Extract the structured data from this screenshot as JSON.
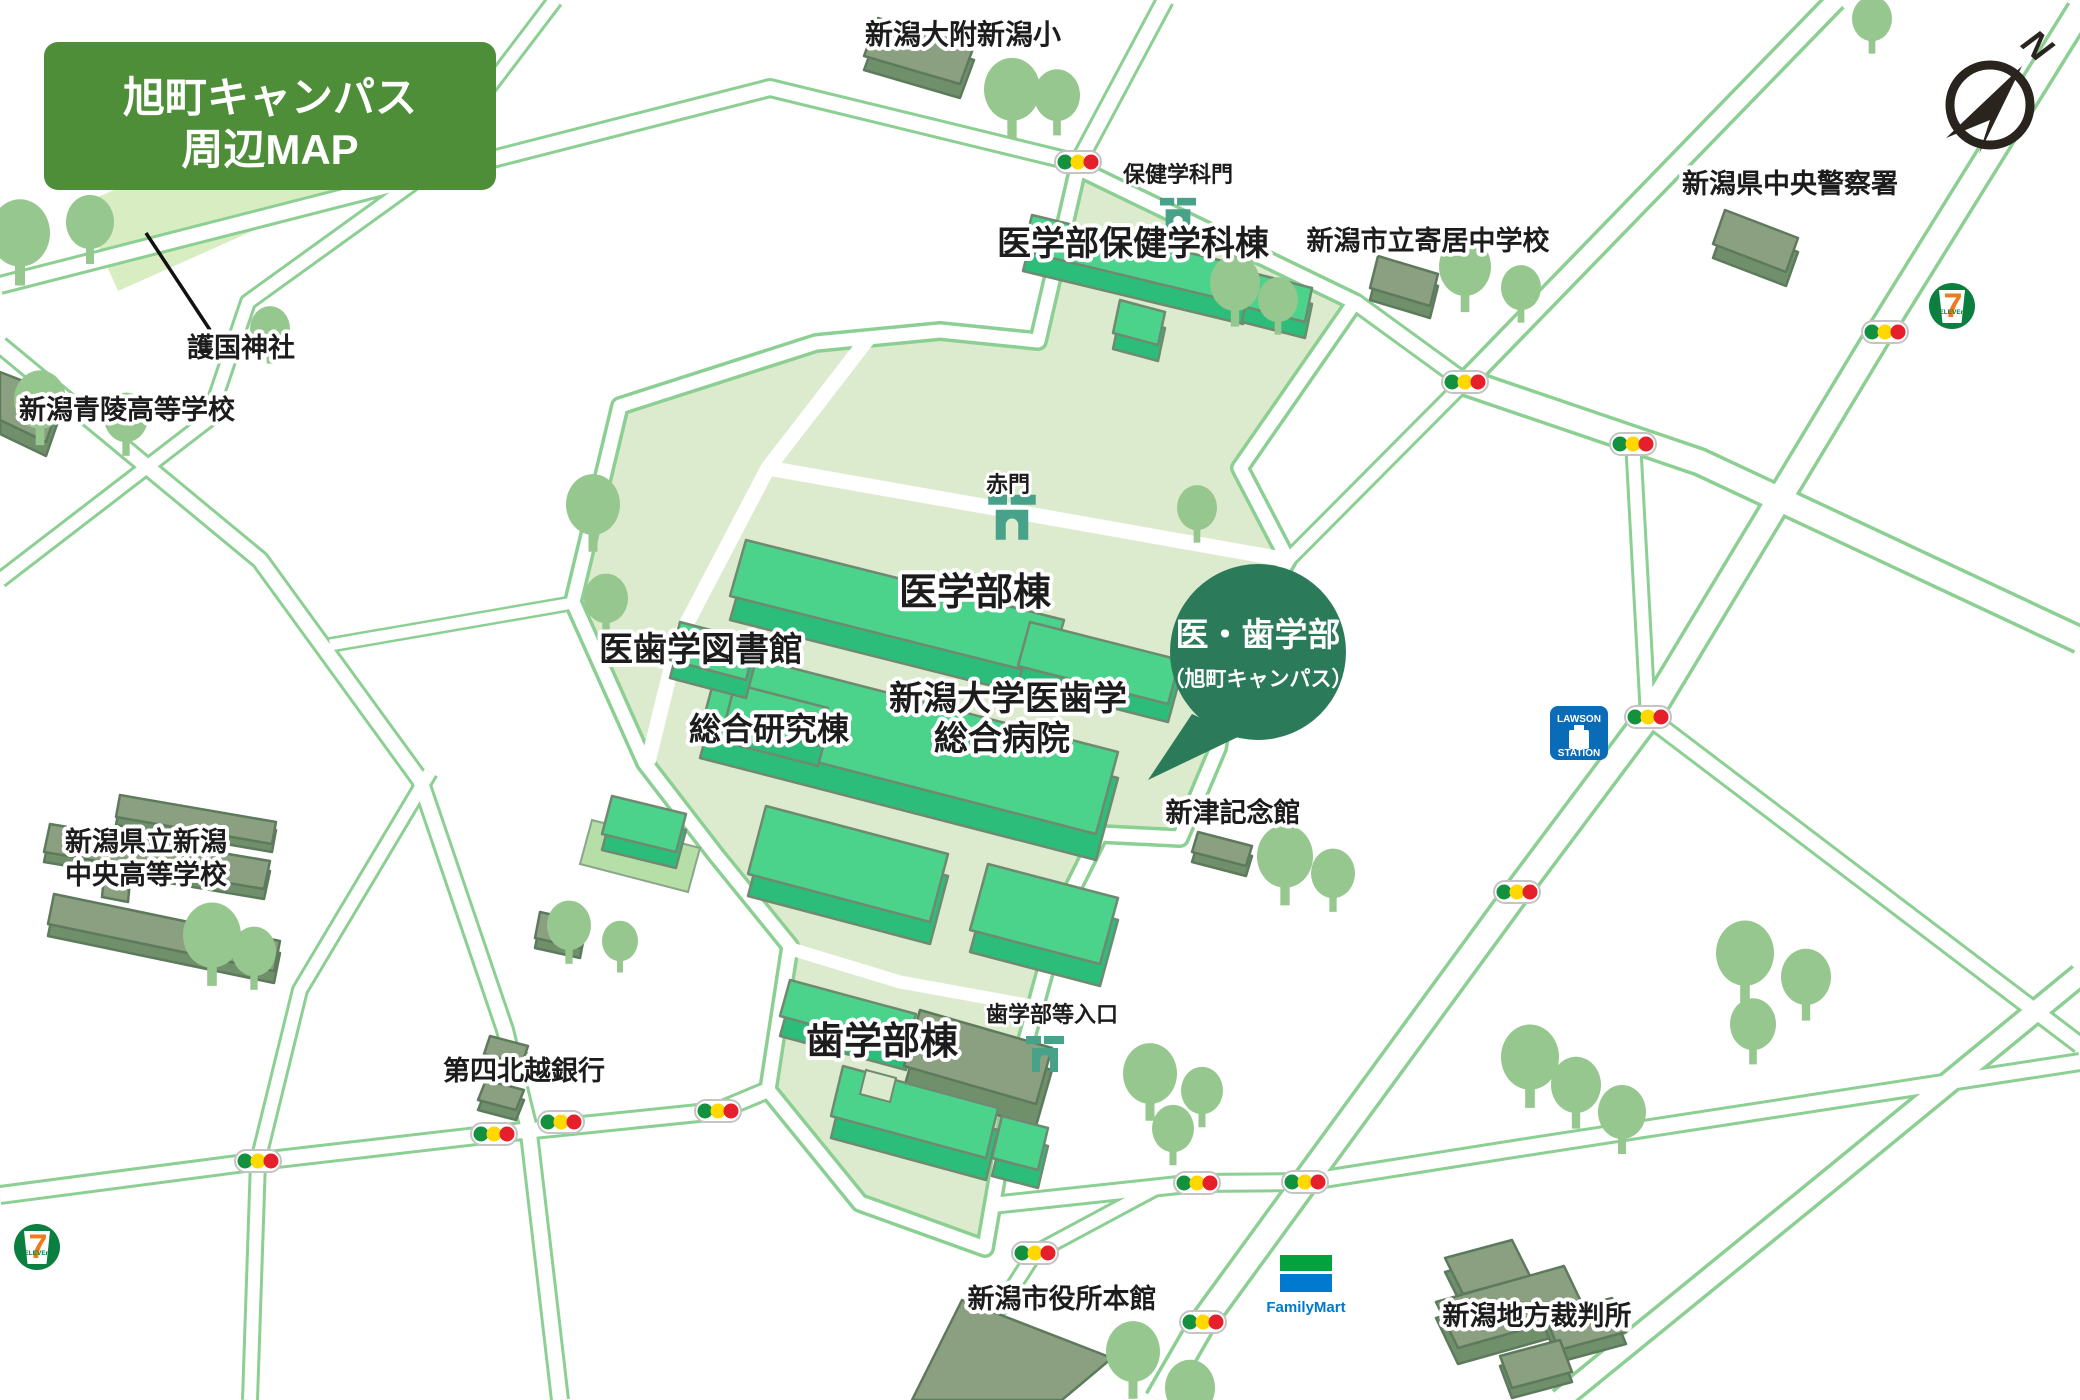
{
  "title": {
    "line1": "旭町キャンパス",
    "line2": "周辺MAP"
  },
  "callout": {
    "line1": "医・歯学部",
    "line2": "（旭町キャンパス）"
  },
  "labels": {
    "elementary": "新潟大附新潟小",
    "health_gate": "保健学科門",
    "health_dept": "医学部保健学科棟",
    "yorii_jhs": "新潟市立寄居中学校",
    "police": "新潟県中央警察署",
    "shrine": "護国神社",
    "seiryo_hs": "新潟青陵高等学校",
    "akamon": "赤門",
    "med_bldg": "医学部棟",
    "library": "医歯学図書館",
    "research": "総合研究棟",
    "hospital_l1": "新潟大学医歯学",
    "hospital_l2": "総合病院",
    "niitsu": "新津記念館",
    "dent_gate": "歯学部等入口",
    "dent_bldg": "歯学部棟",
    "chuo_hs_l1": "新潟県立新潟",
    "chuo_hs_l2": "中央高等学校",
    "bank": "第四北越銀行",
    "city_hall": "新潟市役所本館",
    "court": "新潟地方裁判所"
  },
  "stores": {
    "seven_7": "7",
    "seven_eleven": "ELEVEn",
    "lawson_top": "LAWSON",
    "lawson_bottom": "STATION",
    "familymart": "FamilyMart"
  },
  "compass": {
    "letter": "N"
  },
  "colors": {
    "title_bg": "#4e8e39",
    "campus": "#dcebcd",
    "shrine": "#d9edc3",
    "road_casing": "#8ccf93",
    "building_top": "#4bd38b",
    "building_side": "#2dbd7a",
    "offcampus_building": "#8ba081",
    "tree": "#96c78e",
    "gate": "#47a289",
    "callout_bg": "#2b7a5a",
    "signal_green": "#14913f",
    "signal_yellow": "#ffd800",
    "signal_red": "#e51f2b",
    "seven_green": "#0b7f3f",
    "seven_orange": "#ef7b1a",
    "lawson_blue": "#0a6bb7",
    "familymart_green": "#00a33e",
    "familymart_blue": "#0079cf"
  },
  "map": {
    "trees": [
      [
        20,
        238,
        30
      ],
      [
        90,
        226,
        24
      ],
      [
        40,
        404,
        26
      ],
      [
        126,
        421,
        22
      ],
      [
        270,
        332,
        20
      ],
      [
        1012,
        94,
        28
      ],
      [
        1057,
        99,
        23
      ],
      [
        1235,
        287,
        25
      ],
      [
        1278,
        303,
        20
      ],
      [
        1465,
        271,
        26
      ],
      [
        1521,
        291,
        20
      ],
      [
        1872,
        22,
        20
      ],
      [
        1197,
        511,
        20
      ],
      [
        593,
        509,
        27
      ],
      [
        606,
        602,
        22
      ],
      [
        569,
        929,
        22
      ],
      [
        620,
        944,
        18
      ],
      [
        212,
        940,
        29
      ],
      [
        254,
        955,
        22
      ],
      [
        1285,
        861,
        28
      ],
      [
        1333,
        877,
        22
      ],
      [
        1530,
        1062,
        29
      ],
      [
        1576,
        1089,
        25
      ],
      [
        1622,
        1116,
        24
      ],
      [
        1745,
        958,
        29
      ],
      [
        1806,
        981,
        25
      ],
      [
        1753,
        1028,
        23
      ],
      [
        1150,
        1078,
        27
      ],
      [
        1202,
        1094,
        21
      ],
      [
        1173,
        1132,
        21
      ],
      [
        1133,
        1356,
        27
      ],
      [
        1190,
        1392,
        25
      ]
    ],
    "signals": [
      [
        1078,
        162
      ],
      [
        1885,
        332
      ],
      [
        1465,
        382
      ],
      [
        1633,
        444
      ],
      [
        1648,
        717
      ],
      [
        1517,
        892
      ],
      [
        494,
        1134
      ],
      [
        561,
        1122
      ],
      [
        718,
        1111
      ],
      [
        258,
        1161
      ],
      [
        1197,
        1183
      ],
      [
        1305,
        1182
      ],
      [
        1035,
        1253
      ],
      [
        1203,
        1322
      ]
    ],
    "buildings": [
      {
        "k": "green",
        "d": 20,
        "pts": [
          [
            1032,
            215
          ],
          [
            1252,
            268
          ],
          [
            1243,
            304
          ],
          [
            1023,
            251
          ]
        ]
      },
      {
        "k": "green",
        "d": 16,
        "pts": [
          [
            1249,
            272
          ],
          [
            1312,
            288
          ],
          [
            1305,
            322
          ],
          [
            1242,
            306
          ]
        ]
      },
      {
        "k": "green",
        "d": 16,
        "pts": [
          [
            1120,
            300
          ],
          [
            1165,
            312
          ],
          [
            1158,
            345
          ],
          [
            1113,
            333
          ]
        ]
      },
      {
        "k": "green",
        "d": 24,
        "pts": [
          [
            746,
            540
          ],
          [
            1064,
            620
          ],
          [
            1048,
            676
          ],
          [
            730,
            596
          ]
        ]
      },
      {
        "k": "green",
        "d": 18,
        "pts": [
          [
            1030,
            622
          ],
          [
            1180,
            660
          ],
          [
            1168,
            704
          ],
          [
            1018,
            666
          ]
        ]
      },
      {
        "k": "green",
        "d": 26,
        "pts": [
          [
            722,
            650
          ],
          [
            1118,
            752
          ],
          [
            1096,
            834
          ],
          [
            700,
            732
          ]
        ]
      },
      {
        "k": "pad",
        "d": 0,
        "pts": [
          [
            592,
            820
          ],
          [
            700,
            848
          ],
          [
            688,
            892
          ],
          [
            580,
            864
          ]
        ]
      },
      {
        "k": "green",
        "d": 16,
        "pts": [
          [
            612,
            796
          ],
          [
            686,
            814
          ],
          [
            676,
            852
          ],
          [
            602,
            834
          ]
        ]
      },
      {
        "k": "green",
        "d": 22,
        "pts": [
          [
            766,
            806
          ],
          [
            948,
            854
          ],
          [
            930,
            922
          ],
          [
            748,
            874
          ]
        ]
      },
      {
        "k": "green",
        "d": 22,
        "pts": [
          [
            988,
            864
          ],
          [
            1118,
            898
          ],
          [
            1100,
            964
          ],
          [
            970,
            930
          ]
        ]
      },
      {
        "k": "green",
        "d": 20,
        "pts": [
          [
            735,
            684
          ],
          [
            828,
            708
          ],
          [
            818,
            746
          ],
          [
            725,
            722
          ]
        ]
      },
      {
        "k": "green",
        "d": 18,
        "pts": [
          [
            680,
            622
          ],
          [
            756,
            642
          ],
          [
            746,
            680
          ],
          [
            670,
            660
          ]
        ]
      },
      {
        "k": "green",
        "d": 20,
        "pts": [
          [
            790,
            980
          ],
          [
            916,
            1014
          ],
          [
            906,
            1050
          ],
          [
            780,
            1016
          ]
        ]
      },
      {
        "k": "gray",
        "d": 22,
        "pts": [
          [
            920,
            1010
          ],
          [
            1052,
            1048
          ],
          [
            1036,
            1104
          ],
          [
            904,
            1066
          ]
        ]
      },
      {
        "k": "green",
        "d": 22,
        "pts": [
          [
            843,
            1066
          ],
          [
            998,
            1108
          ],
          [
            986,
            1158
          ],
          [
            831,
            1116
          ]
        ]
      },
      {
        "k": "green",
        "d": 18,
        "pts": [
          [
            1002,
            1116
          ],
          [
            1048,
            1128
          ],
          [
            1038,
            1170
          ],
          [
            992,
            1158
          ]
        ]
      },
      {
        "k": "gray",
        "d": 14,
        "pts": [
          [
            878,
            18
          ],
          [
            974,
            46
          ],
          [
            960,
            84
          ],
          [
            864,
            56
          ]
        ]
      },
      {
        "k": "gray",
        "d": 12,
        "pts": [
          [
            1378,
            256
          ],
          [
            1438,
            274
          ],
          [
            1430,
            306
          ],
          [
            1370,
            288
          ]
        ]
      },
      {
        "k": "gray",
        "d": 14,
        "pts": [
          [
            1725,
            210
          ],
          [
            1798,
            238
          ],
          [
            1786,
            272
          ],
          [
            1713,
            244
          ]
        ]
      },
      {
        "k": "gray",
        "d": 14,
        "pts": [
          [
            0,
            372
          ],
          [
            62,
            396
          ],
          [
            46,
            442
          ],
          [
            0,
            420
          ]
        ]
      },
      {
        "k": "gray",
        "d": 8,
        "pts": [
          [
            120,
            795
          ],
          [
            276,
            822
          ],
          [
            272,
            844
          ],
          [
            116,
            817
          ]
        ]
      },
      {
        "k": "gray",
        "d": 10,
        "pts": [
          [
            50,
            824
          ],
          [
            270,
            861
          ],
          [
            264,
            889
          ],
          [
            44,
            852
          ]
        ]
      },
      {
        "k": "gray",
        "d": 12,
        "pts": [
          [
            54,
            894
          ],
          [
            280,
            941
          ],
          [
            274,
            971
          ],
          [
            48,
            924
          ]
        ]
      },
      {
        "k": "gray",
        "d": 0,
        "pts": [
          [
            108,
            833
          ],
          [
            134,
            838
          ],
          [
            128,
            902
          ],
          [
            102,
            897
          ]
        ]
      },
      {
        "k": "gray",
        "d": 10,
        "pts": [
          [
            1198,
            832
          ],
          [
            1252,
            846
          ],
          [
            1246,
            866
          ],
          [
            1192,
            852
          ]
        ]
      },
      {
        "k": "gray",
        "d": 8,
        "pts": [
          [
            490,
            1036
          ],
          [
            528,
            1046
          ],
          [
            522,
            1064
          ],
          [
            484,
            1054
          ]
        ]
      },
      {
        "k": "gray",
        "d": 10,
        "pts": [
          [
            486,
            1080
          ],
          [
            524,
            1090
          ],
          [
            516,
            1110
          ],
          [
            478,
            1100
          ]
        ]
      },
      {
        "k": "gray",
        "d": 0,
        "pts": [
          [
            962,
            1300
          ],
          [
            1112,
            1358
          ],
          [
            1062,
            1400
          ],
          [
            912,
            1400
          ]
        ]
      },
      {
        "k": "gray",
        "d": 14,
        "pts": [
          [
            1445,
            1258
          ],
          [
            1512,
            1240
          ],
          [
            1530,
            1276
          ],
          [
            1463,
            1294
          ]
        ]
      },
      {
        "k": "gray",
        "d": 16,
        "pts": [
          [
            1436,
            1302
          ],
          [
            1564,
            1266
          ],
          [
            1586,
            1312
          ],
          [
            1458,
            1348
          ]
        ]
      },
      {
        "k": "gray",
        "d": 12,
        "pts": [
          [
            1545,
            1316
          ],
          [
            1612,
            1298
          ],
          [
            1626,
            1332
          ],
          [
            1559,
            1350
          ]
        ]
      },
      {
        "k": "gray",
        "d": 10,
        "pts": [
          [
            1500,
            1356
          ],
          [
            1560,
            1340
          ],
          [
            1572,
            1372
          ],
          [
            1512,
            1388
          ]
        ]
      },
      {
        "k": "gray",
        "d": 10,
        "pts": [
          [
            540,
            912
          ],
          [
            585,
            922
          ],
          [
            580,
            948
          ],
          [
            535,
            938
          ]
        ]
      }
    ]
  }
}
